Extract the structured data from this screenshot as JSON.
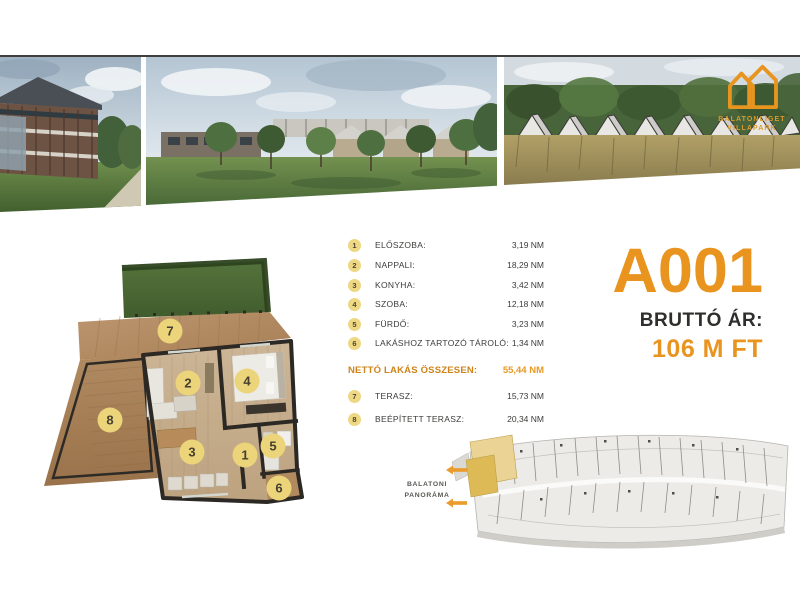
{
  "accent_color": "#e8941f",
  "marker_color": "#ecd47b",
  "highlight_color": "#e3c36a",
  "logo": {
    "line1": "BALATONLIGET",
    "line2": "VILLAPARK"
  },
  "unit": {
    "code": "A001",
    "price_label": "BRUTTÓ ÁR:",
    "price_value": "106 M FT"
  },
  "rooms": [
    {
      "num": "1",
      "label": "ELŐSZOBA:",
      "value": "3,19 NM"
    },
    {
      "num": "2",
      "label": "NAPPALI:",
      "value": "18,29 NM"
    },
    {
      "num": "3",
      "label": "KONYHA:",
      "value": "3,42 NM"
    },
    {
      "num": "4",
      "label": "SZOBA:",
      "value": "12,18 NM"
    },
    {
      "num": "5",
      "label": "FÜRDŐ:",
      "value": "3,23 NM"
    },
    {
      "num": "6",
      "label": "LAKÁSHOZ TARTOZÓ TÁROLÓ:",
      "value": "1,34 NM"
    }
  ],
  "total": {
    "label": "NETTÓ LAKÁS ÖSSZESEN:",
    "value": "55,44 NM"
  },
  "outdoor": [
    {
      "num": "7",
      "label": "TERASZ:",
      "value": "15,73 NM"
    },
    {
      "num": "8",
      "label": "BEÉPÍTETT TERASZ:",
      "value": "20,34 NM"
    }
  ],
  "floorplan": {
    "markers": [
      "1",
      "2",
      "3",
      "4",
      "5",
      "6",
      "7",
      "8"
    ]
  },
  "siteplan": {
    "caption1": "BALATONI",
    "caption2": "PANORÁMA"
  },
  "icons": {
    "logo": "double-house-outline-icon",
    "site_arrows": "left-arrow-icon"
  }
}
